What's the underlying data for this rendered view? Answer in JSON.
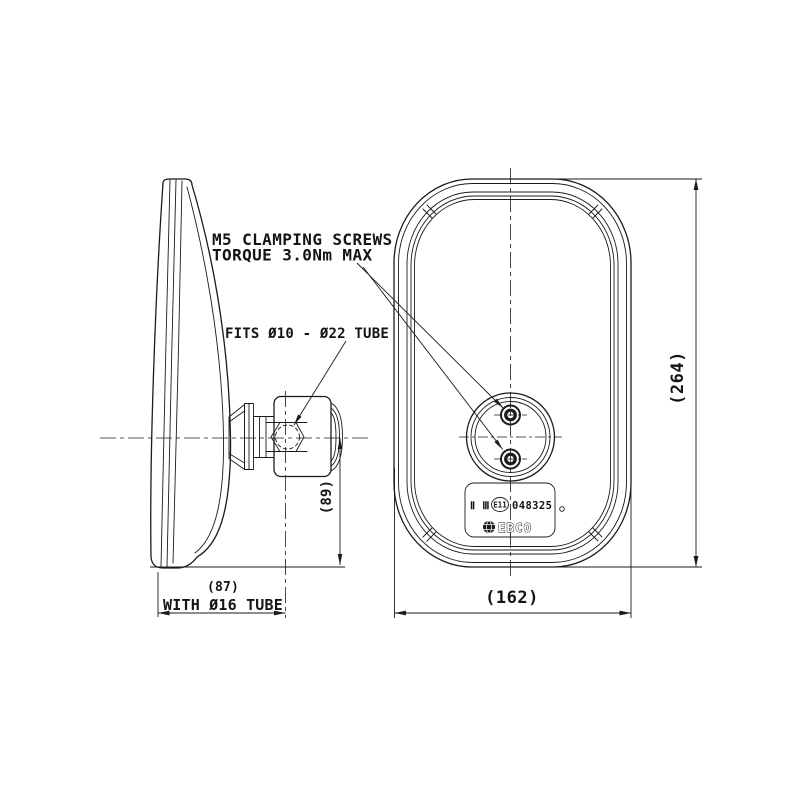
{
  "page": {
    "background_color": "#ffffff",
    "line_color": "#1b1b1b"
  },
  "annotations": {
    "clamping_note": {
      "line1": "M5 CLAMPING SCREWS",
      "line2": "TORQUE 3.0Nm MAX"
    },
    "tube_fit_note": "FITS Ø10 - Ø22 TUBE"
  },
  "dimensions": {
    "overall_height": "(264)",
    "overall_width": "(162)",
    "center_to_bottom": "(89)",
    "depth": "(87)",
    "depth_qualifier": "WITH Ø16 TUBE"
  },
  "approval_label": {
    "class_marks": "Ⅱ Ⅲ",
    "e_mark": "E11",
    "approval_number": "048325",
    "brand": "EBCO"
  }
}
